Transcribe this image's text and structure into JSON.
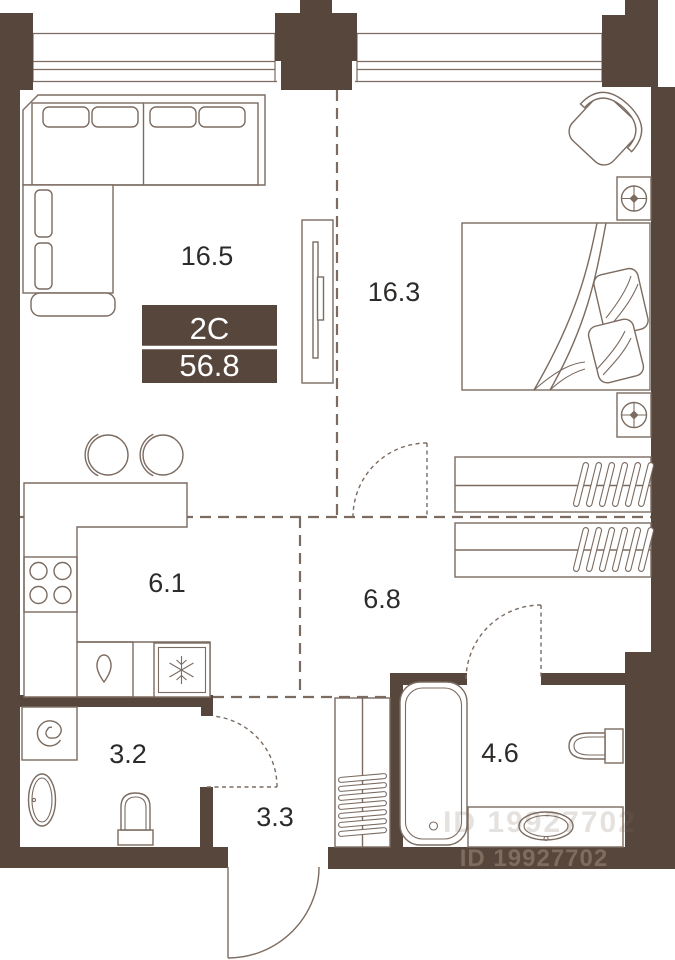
{
  "plan": {
    "unit_badge": {
      "type_label": "2C",
      "area_label": "56.8"
    },
    "rooms": {
      "living": {
        "label": "16.5"
      },
      "bedroom": {
        "label": "16.3"
      },
      "kitchen": {
        "label": "6.1"
      },
      "hall": {
        "label": "6.8"
      },
      "wc": {
        "label": "3.2"
      },
      "entry": {
        "label": "3.3"
      },
      "bathroom": {
        "label": "4.6"
      }
    },
    "watermark": {
      "id_text": "ID 19927702"
    },
    "furniture": [
      "corner-sofa",
      "tv-stand",
      "bar-stools",
      "kitchen-counter",
      "stove",
      "kitchen-sink",
      "fridge",
      "washing-machine",
      "pedestal-sink",
      "wc-toilet",
      "hall-cabinet",
      "bathtub",
      "vanity-sink",
      "bath-toilet",
      "double-bed",
      "nightstand-lamp",
      "armchair",
      "wardrobe-hangers"
    ],
    "colors": {
      "wall": "#57463c",
      "line": "#7b6b60",
      "text": "#2d2b29",
      "badge_bg": "#57463c",
      "badge_text": "#ffffff",
      "watermark": "#7e6c5e"
    }
  }
}
